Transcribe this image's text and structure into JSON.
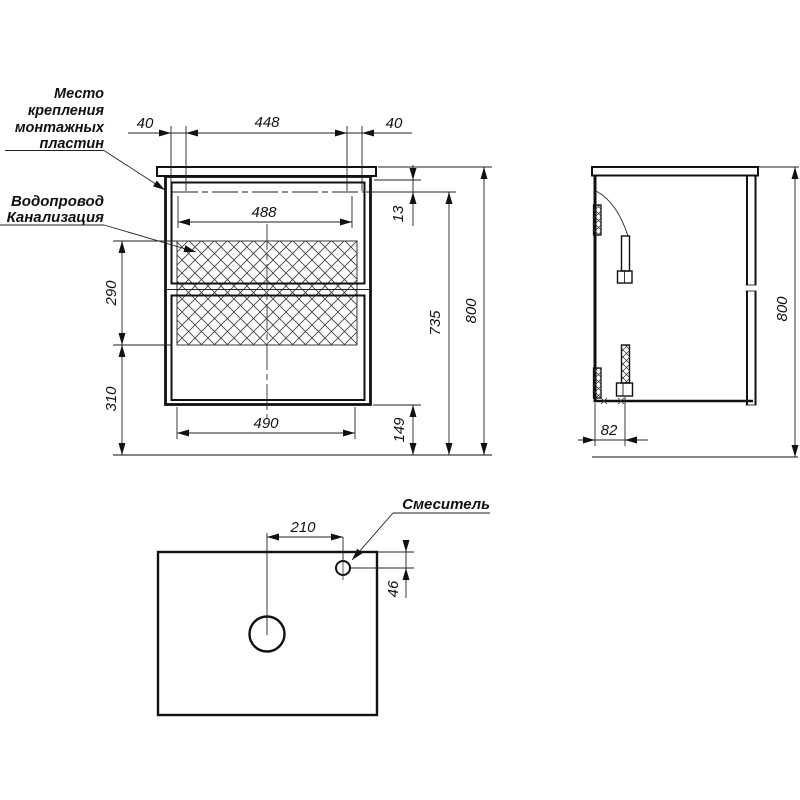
{
  "labels": {
    "mounting_plates": [
      "Место",
      "крепления",
      "монтажных",
      "пластин"
    ],
    "plumbing": [
      "Водопровод",
      "Канализация"
    ],
    "mixer": "Смеситель"
  },
  "dims": {
    "front": {
      "left_offset": "40",
      "plate_span": "448",
      "right_offset": "40",
      "plate_centers": "488",
      "top_inset": "13",
      "service_zone_height": "290",
      "lower_zone_height": "310",
      "drawer_width": "490",
      "floor_clearance": "149",
      "body_height": "735",
      "overall_height": "800"
    },
    "side": {
      "plate_depth": "82",
      "overall_height": "800"
    },
    "plan": {
      "mixer_offset": "210",
      "mixer_edge_inset": "46"
    }
  },
  "colors": {
    "line": "#111111",
    "background": "#ffffff"
  }
}
